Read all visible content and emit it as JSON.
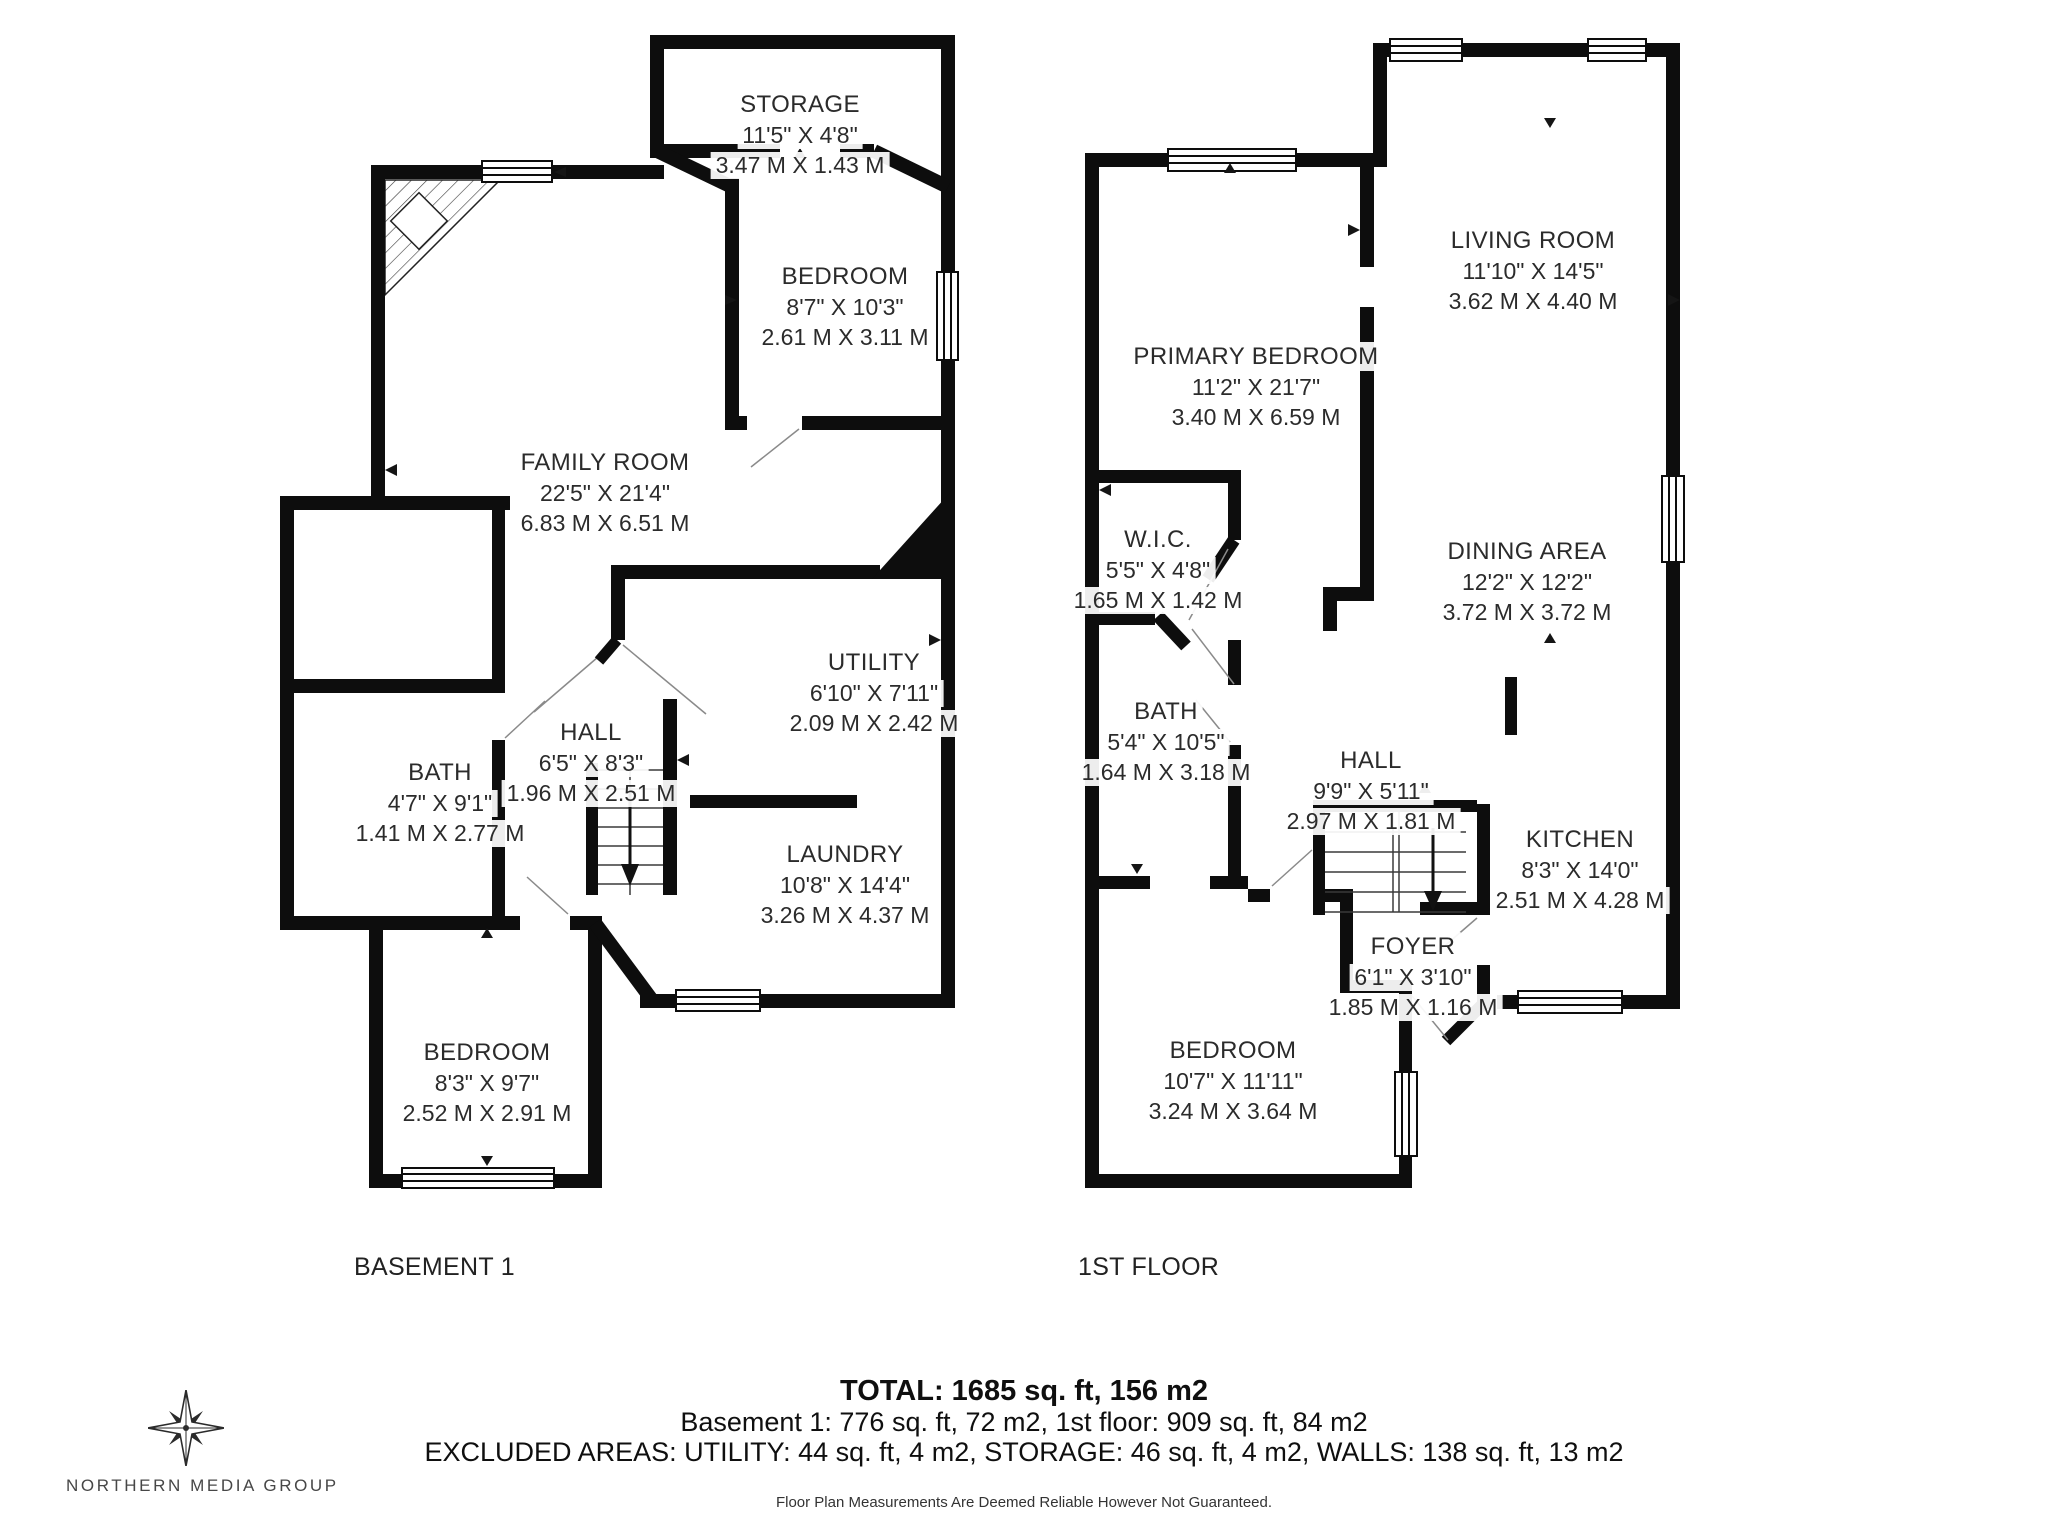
{
  "colors": {
    "wall": "#0d0d0d",
    "text": "#2b2b2b"
  },
  "floors": [
    {
      "label": "BASEMENT 1",
      "rooms": [
        {
          "name": "STORAGE",
          "imperial": "11'5\" X 4'8\"",
          "metric": "3.47 M X 1.43 M"
        },
        {
          "name": "BEDROOM",
          "imperial": "8'7\" X 10'3\"",
          "metric": "2.61 M X 3.11 M"
        },
        {
          "name": "FAMILY ROOM",
          "imperial": "22'5\" X 21'4\"",
          "metric": "6.83 M X 6.51 M"
        },
        {
          "name": "UTILITY",
          "imperial": "6'10\" X 7'11\"",
          "metric": "2.09 M X 2.42 M"
        },
        {
          "name": "HALL",
          "imperial": "6'5\" X 8'3\"",
          "metric": "1.96 M X 2.51 M"
        },
        {
          "name": "BATH",
          "imperial": "4'7\" X 9'1\"",
          "metric": "1.41 M X 2.77 M"
        },
        {
          "name": "LAUNDRY",
          "imperial": "10'8\" X 14'4\"",
          "metric": "3.26 M X 4.37 M"
        },
        {
          "name": "BEDROOM",
          "imperial": "8'3\" X 9'7\"",
          "metric": "2.52 M X 2.91 M"
        }
      ]
    },
    {
      "label": "1ST FLOOR",
      "rooms": [
        {
          "name": "LIVING ROOM",
          "imperial": "11'10\" X 14'5\"",
          "metric": "3.62 M X 4.40 M"
        },
        {
          "name": "PRIMARY BEDROOM",
          "imperial": "11'2\" X 21'7\"",
          "metric": "3.40 M X 6.59 M"
        },
        {
          "name": "W.I.C.",
          "imperial": "5'5\" X 4'8\"",
          "metric": "1.65 M X 1.42 M"
        },
        {
          "name": "DINING AREA",
          "imperial": "12'2\" X 12'2\"",
          "metric": "3.72 M X 3.72 M"
        },
        {
          "name": "BATH",
          "imperial": "5'4\" X 10'5\"",
          "metric": "1.64 M X 3.18 M"
        },
        {
          "name": "HALL",
          "imperial": "9'9\" X 5'11\"",
          "metric": "2.97 M X 1.81 M"
        },
        {
          "name": "KITCHEN",
          "imperial": "8'3\" X 14'0\"",
          "metric": "2.51 M X 4.28 M"
        },
        {
          "name": "FOYER",
          "imperial": "6'1\" X 3'10\"",
          "metric": "1.85 M X 1.16 M"
        },
        {
          "name": "BEDROOM",
          "imperial": "10'7\" X 11'11\"",
          "metric": "3.24 M X 3.64 M"
        }
      ]
    }
  ],
  "summary": {
    "total": "TOTAL: 1685 sq. ft, 156 m2",
    "floors_line": "Basement 1: 776 sq. ft, 72 m2, 1st floor: 909 sq. ft, 84 m2",
    "excluded_line": "EXCLUDED AREAS: UTILITY: 44 sq. ft, 4 m2, STORAGE: 46 sq. ft, 4 m2, WALLS: 138 sq. ft, 13 m2",
    "disclaimer": "Floor Plan Measurements Are Deemed Reliable However Not Guaranteed."
  },
  "logo": {
    "icon": "compass-rose-icon",
    "text": "NORTHERN MEDIA GROUP"
  }
}
